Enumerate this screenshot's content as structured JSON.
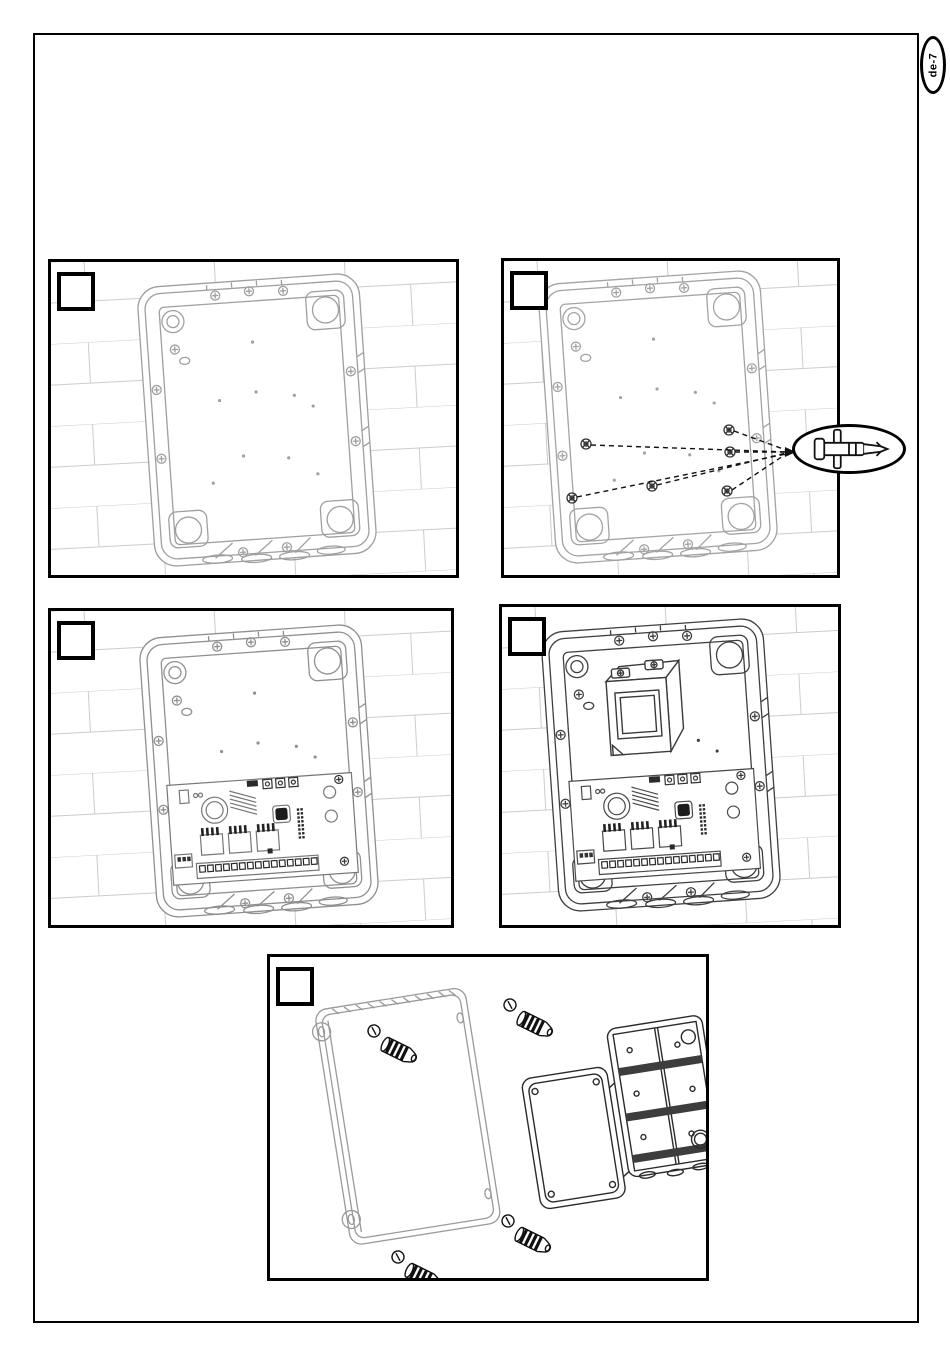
{
  "page": {
    "label": "de-7"
  },
  "panels": [
    {
      "id": "panel-1",
      "step_label": "",
      "description": "empty back box mounted on brick wall"
    },
    {
      "id": "panel-2",
      "step_label": "",
      "description": "back box with standoff positions called out"
    },
    {
      "id": "panel-3",
      "step_label": "",
      "description": "back box with control board installed"
    },
    {
      "id": "panel-4",
      "step_label": "",
      "description": "back box with control board and transformer"
    },
    {
      "id": "panel-5",
      "step_label": "",
      "description": "cover with fixing screws and auxiliary junction box"
    }
  ],
  "callout": {
    "icon": "pcb-standoff"
  },
  "colors": {
    "border": "#000000",
    "wall_line": "#cccccc",
    "line_light": "#9f9f9f",
    "line_dark": "#3f3f3f",
    "accent_dark": "#111111"
  }
}
